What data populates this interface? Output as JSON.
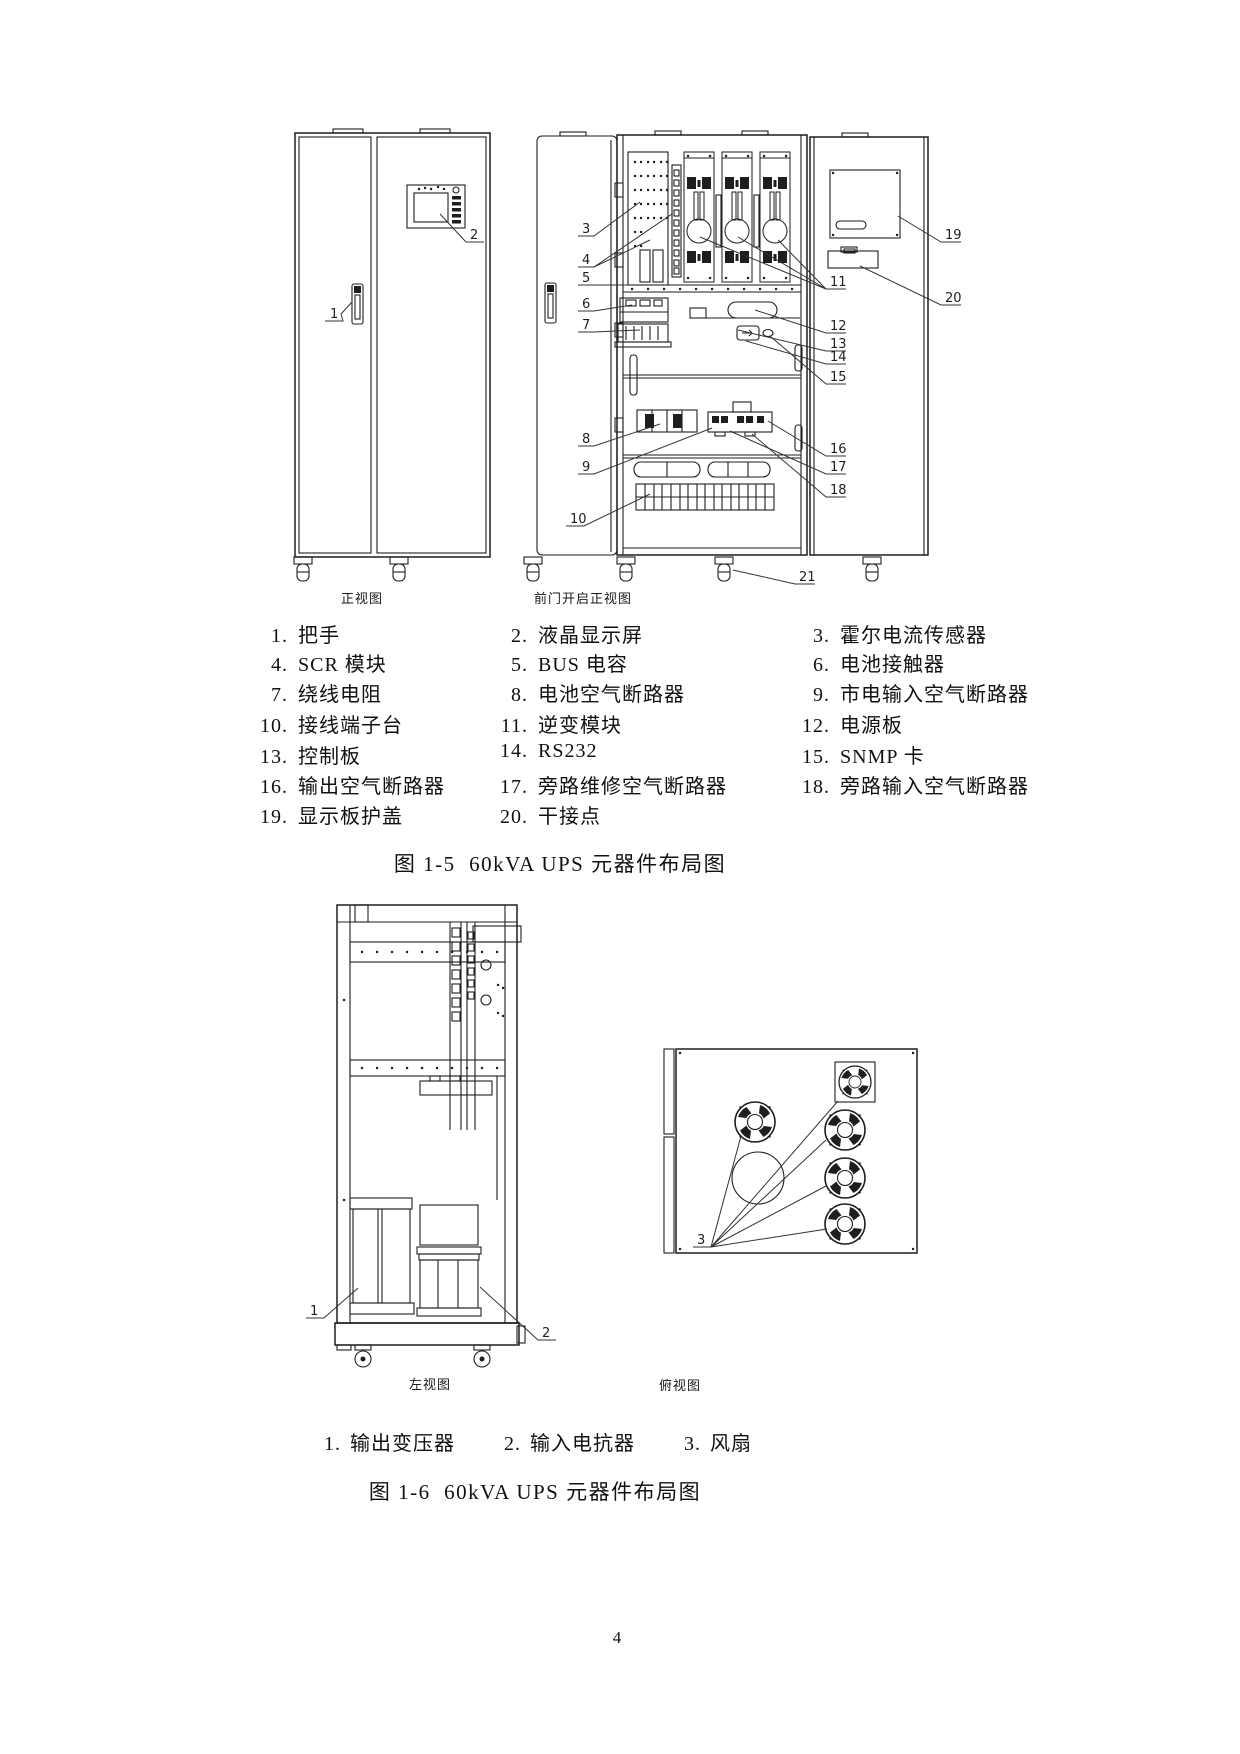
{
  "page": {
    "number": "4"
  },
  "figure_1_5": {
    "caption": "图 1-5  60kVA UPS 元器件布局图",
    "views": {
      "front": "正视图",
      "open": "前门开启正视图"
    },
    "callouts": [
      "1",
      "2",
      "3",
      "4",
      "5",
      "6",
      "7",
      "8",
      "9",
      "10",
      "11",
      "12",
      "13",
      "14",
      "15",
      "16",
      "17",
      "18",
      "19",
      "20",
      "21"
    ],
    "legend_rows": [
      [
        {
          "n": "1",
          "label": "把手"
        },
        {
          "n": "2",
          "label": "液晶显示屏"
        },
        {
          "n": "3",
          "label": "霍尔电流传感器"
        }
      ],
      [
        {
          "n": "4",
          "label": "SCR 模块"
        },
        {
          "n": "5",
          "label": "BUS 电容"
        },
        {
          "n": "6",
          "label": "电池接触器"
        }
      ],
      [
        {
          "n": "7",
          "label": "绕线电阻"
        },
        {
          "n": "8",
          "label": "电池空气断路器"
        },
        {
          "n": "9",
          "label": "市电输入空气断路器"
        }
      ],
      [
        {
          "n": "10",
          "label": "接线端子台"
        },
        {
          "n": "11",
          "label": "逆变模块"
        },
        {
          "n": "12",
          "label": "电源板"
        }
      ],
      [
        {
          "n": "13",
          "label": "控制板"
        },
        {
          "n": "14",
          "label": "RS232"
        },
        {
          "n": "15",
          "label": "SNMP 卡"
        }
      ],
      [
        {
          "n": "16",
          "label": "输出空气断路器"
        },
        {
          "n": "17",
          "label": "旁路维修空气断路器"
        },
        {
          "n": "18",
          "label": "旁路输入空气断路器"
        }
      ],
      [
        {
          "n": "19",
          "label": "显示板护盖"
        },
        {
          "n": "20",
          "label": "干接点"
        }
      ]
    ]
  },
  "figure_1_6": {
    "caption": "图 1-6  60kVA UPS 元器件布局图",
    "views": {
      "left": "左视图",
      "top": "俯视图"
    },
    "callouts": [
      "1",
      "2",
      "3"
    ],
    "legend_rows": [
      [
        {
          "n": "1",
          "label": "输出变压器"
        },
        {
          "n": "2",
          "label": "输入电抗器"
        },
        {
          "n": "3",
          "label": "风扇"
        }
      ]
    ]
  }
}
